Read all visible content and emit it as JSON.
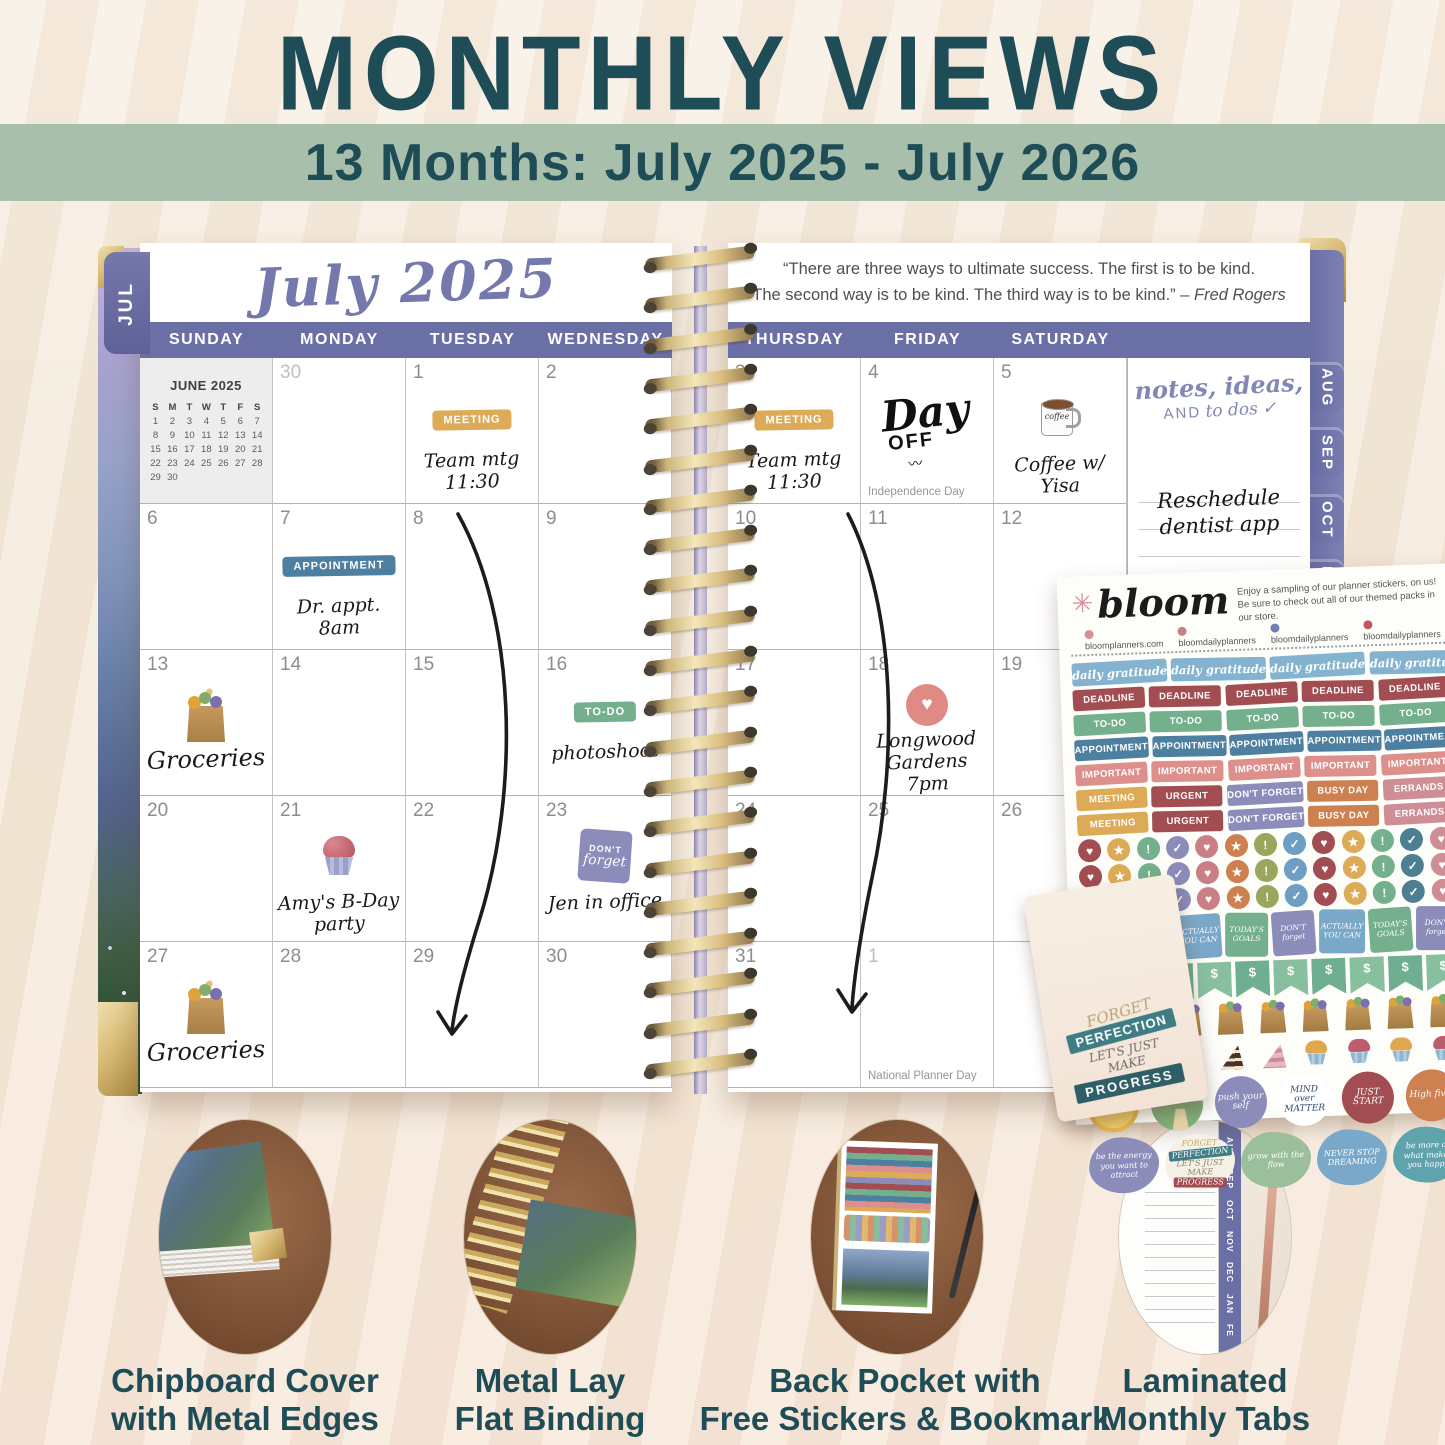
{
  "header": {
    "title": "MONTHLY VIEWS",
    "subtitle": "13 Months: July 2025 - July 2026"
  },
  "colors": {
    "accent_teal": "#1e4c57",
    "banner_green": "#a8bfac",
    "calendar_purple": "#6a6fa5",
    "script_purple": "#7478ad",
    "spiral_gold": "#d9bd7e"
  },
  "planner": {
    "left_tab": "JUL",
    "month_title": "July 2025",
    "days_left": [
      "SUNDAY",
      "MONDAY",
      "TUESDAY",
      "WEDNESDAY"
    ],
    "days_right": [
      "THURSDAY",
      "FRIDAY",
      "SATURDAY"
    ],
    "quote_line1": "“There are three ways to ultimate success. The first is to be kind.",
    "quote_line2": "The second way is to be kind. The third way is to be kind.” –",
    "quote_attr": "Fred Rogers",
    "mini_calendar": {
      "title": "JUNE 2025",
      "dow": [
        "S",
        "M",
        "T",
        "W",
        "T",
        "F",
        "S"
      ],
      "weeks": [
        [
          "1",
          "2",
          "3",
          "4",
          "5",
          "6",
          "7"
        ],
        [
          "8",
          "9",
          "10",
          "11",
          "12",
          "13",
          "14"
        ],
        [
          "15",
          "16",
          "17",
          "18",
          "19",
          "20",
          "21"
        ],
        [
          "22",
          "23",
          "24",
          "25",
          "26",
          "27",
          "28"
        ],
        [
          "29",
          "30",
          "",
          "",
          "",
          "",
          ""
        ]
      ]
    },
    "left_cells": [
      {
        "mini": true
      },
      {
        "num": "30",
        "dim": true
      },
      {
        "num": "1",
        "sticker": {
          "label": "MEETING",
          "color": "#ddab57"
        },
        "notes": [
          "Team mtg",
          "11:30"
        ]
      },
      {
        "num": "2"
      },
      {
        "num": "6"
      },
      {
        "num": "7",
        "sticker": {
          "label": "APPOINTMENT",
          "color": "#4d7fa0"
        },
        "notes": [
          "Dr. appt.",
          "8am"
        ]
      },
      {
        "num": "8"
      },
      {
        "num": "9"
      },
      {
        "num": "13",
        "icon": "grocery-bag",
        "notes": [
          "Groceries"
        ],
        "big": true
      },
      {
        "num": "14"
      },
      {
        "num": "15"
      },
      {
        "num": "16",
        "sticker": {
          "label": "TO-DO",
          "color": "#74b08d"
        },
        "notes": [
          "photoshoot"
        ]
      },
      {
        "num": "20"
      },
      {
        "num": "21",
        "icon": "cupcake",
        "notes": [
          "Amy's B-Day",
          "party"
        ]
      },
      {
        "num": "22"
      },
      {
        "num": "23",
        "icon": "dont-forget",
        "notes": [
          "Jen in office"
        ]
      },
      {
        "num": "27",
        "icon": "grocery-bag",
        "notes": [
          "Groceries"
        ],
        "big": true
      },
      {
        "num": "28"
      },
      {
        "num": "29"
      },
      {
        "num": "30"
      }
    ],
    "right_cells": [
      {
        "num": "3",
        "sticker": {
          "label": "MEETING",
          "color": "#ddab57"
        },
        "notes": [
          "Team mtg",
          "11:30"
        ]
      },
      {
        "num": "4",
        "dayoff": true,
        "foot": "Independence Day"
      },
      {
        "num": "5",
        "icon": "coffee-mug",
        "notes": [
          "Coffee w/",
          "Yisa"
        ]
      },
      {
        "num": "10"
      },
      {
        "num": "11"
      },
      {
        "num": "12"
      },
      {
        "num": "17"
      },
      {
        "num": "18",
        "icon": "heart",
        "notes": [
          "Longwood",
          "Gardens",
          "7pm"
        ]
      },
      {
        "num": "19"
      },
      {
        "num": "24"
      },
      {
        "num": "25"
      },
      {
        "num": "26"
      },
      {
        "num": "31"
      },
      {
        "num": "1",
        "dim": true,
        "foot": "National Planner Day"
      },
      {
        "aug": true
      }
    ],
    "day_off_line1": "Day",
    "day_off_line2": "OFF",
    "day_off_underline": "〰",
    "mug_text": "coffee",
    "dont_forget_sticker": {
      "line1": "DON'T",
      "line2": "forget"
    },
    "heart_glyph": "♥",
    "aug_mini": {
      "head": "A",
      "dow": "S",
      "col": [
        "3",
        "10",
        "17",
        "24",
        "31"
      ]
    },
    "notes_panel": {
      "title_line1": "notes, ideas,",
      "title_and": "AND",
      "title_line2": "to dos",
      "title_check": "✓",
      "entry": [
        "Reschedule",
        "dentist app"
      ]
    },
    "tabs_right": [
      "AUG",
      "SEP",
      "OCT",
      "NOV"
    ]
  },
  "sticker_sheet": {
    "brand": "bloom",
    "flower_glyph": "✳",
    "tagline1": "Enjoy a sampling of our planner stickers, on us!",
    "tagline2": "Be sure to check out all of our themed packs in our store.",
    "social": [
      {
        "icon": "flower-icon",
        "color": "#d98f97",
        "text": "bloomplanners.com"
      },
      {
        "icon": "instagram-icon",
        "color": "#c97f85",
        "text": "bloomdailyplanners"
      },
      {
        "icon": "facebook-icon",
        "color": "#6f7fb0",
        "text": "bloomdailyplanners"
      },
      {
        "icon": "pinterest-icon",
        "color": "#c0565e",
        "text": "bloomdailyplanners"
      }
    ],
    "script_row": {
      "label": "daily gratitude",
      "color": "#84b3d0",
      "count": 4
    },
    "label_rows": [
      {
        "labels": [
          "DEADLINE",
          "DEADLINE",
          "DEADLINE",
          "DEADLINE",
          "DEADLINE"
        ],
        "colors": [
          "#a14d52",
          "#a14d52",
          "#a14d52",
          "#a14d52",
          "#a14d52"
        ]
      },
      {
        "labels": [
          "TO-DO",
          "TO-DO",
          "TO-DO",
          "TO-DO",
          "TO-DO"
        ],
        "colors": [
          "#74b08d",
          "#74b08d",
          "#74b08d",
          "#74b08d",
          "#74b08d"
        ]
      },
      {
        "labels": [
          "APPOINTMENT",
          "APPOINTMENT",
          "APPOINTMENT",
          "APPOINTMENT",
          "APPOINTMENT"
        ],
        "colors": [
          "#4d7fa0",
          "#4d7fa0",
          "#4d7fa0",
          "#4d7fa0",
          "#4d7fa0"
        ]
      },
      {
        "labels": [
          "IMPORTANT",
          "IMPORTANT",
          "IMPORTANT",
          "IMPORTANT",
          "IMPORTANT"
        ],
        "colors": [
          "#dd8f8c",
          "#dd8f8c",
          "#dd8f8c",
          "#dd8f8c",
          "#dd8f8c"
        ]
      },
      {
        "labels": [
          "MEETING",
          "URGENT",
          "DON'T FORGET",
          "BUSY DAY",
          "ERRANDS"
        ],
        "colors": [
          "#ddab57",
          "#a14d52",
          "#8b8cba",
          "#cd8050",
          "#cf8d96"
        ]
      },
      {
        "labels": [
          "MEETING",
          "URGENT",
          "DON'T FORGET",
          "BUSY DAY",
          "ERRANDS"
        ],
        "colors": [
          "#ddab57",
          "#a14d52",
          "#8b8cba",
          "#cd8050",
          "#cf8d96"
        ]
      }
    ],
    "dot_rows": 3,
    "dot_icons": [
      "♥",
      "★",
      "!",
      "✓"
    ],
    "dot_colors": [
      "#a14d52",
      "#ddab57",
      "#74b08d",
      "#8b8cba",
      "#c97f85",
      "#cd8050",
      "#9aa65c",
      "#6f9ec4",
      "#a14d52",
      "#ddab57",
      "#74b08d",
      "#4d7f93",
      "#cf8d96"
    ],
    "square_stickers": [
      {
        "text": "TODAY'S GOALS",
        "color": "#74b08d"
      },
      {
        "text": "DON'T forget",
        "color": "#8b8cba"
      },
      {
        "text": "ACTUALLY YOU CAN",
        "color": "#7aa8c9"
      },
      {
        "text": "TODAY'S GOALS",
        "color": "#74b08d"
      },
      {
        "text": "DON'T forget",
        "color": "#8b8cba"
      },
      {
        "text": "ACTUALLY YOU CAN",
        "color": "#7aa8c9"
      },
      {
        "text": "TODAY'S GOALS",
        "color": "#74b08d"
      },
      {
        "text": "DON'T forget",
        "color": "#8b8cba"
      }
    ],
    "flag_label": "$",
    "flag_count": 10,
    "flag_colors": [
      "#6fae8f",
      "#87bf9f"
    ],
    "bag_count": 9,
    "cake_items": [
      "slice-pink",
      "slice-choc",
      "slice-pink",
      "slice-choc",
      "slice-pink",
      "cupcake-gold",
      "cupcake-berry",
      "cupcake-gold",
      "cupcake-berry"
    ],
    "motivation_circles": [
      {
        "type": "sun",
        "text": "☀"
      },
      {
        "type": "path",
        "text": ""
      },
      {
        "type": "text",
        "text": "push your self",
        "color": "#8b8cba",
        "text_color": "#ffffff"
      },
      {
        "type": "text",
        "text": "MIND over MATTER",
        "color": "#ffffff",
        "text_color": "#2f4a6e"
      },
      {
        "type": "text",
        "text": "JUST START",
        "color": "#a14d52",
        "text_color": "#ffffff"
      },
      {
        "type": "text",
        "text": "High five!",
        "color": "#cd8050",
        "text_color": "#ffffff"
      }
    ],
    "quote_stickers": [
      {
        "style": "plain",
        "text": "be the energy you want to attract",
        "color": "#8b8cba"
      },
      {
        "style": "multi",
        "parts": [
          "FORGET",
          "PERFECTION",
          "LET'S JUST MAKE",
          "PROGRESS"
        ]
      },
      {
        "style": "plain",
        "text": "grow with the flow",
        "color": "#9bbf9a"
      },
      {
        "style": "plain",
        "text": "NEVER STOP DREAMING",
        "color": "#7aa8c9"
      },
      {
        "style": "plain",
        "text": "be more of what makes you happy",
        "color": "#5fa3ad"
      }
    ]
  },
  "bookmark": {
    "lines": [
      "FORGET",
      "PERFECTION",
      "LET'S JUST",
      "MAKE",
      "PROGRESS"
    ]
  },
  "features": [
    {
      "caption": [
        "Chipboard Cover",
        "with Metal Edges"
      ]
    },
    {
      "caption": [
        "Metal Lay",
        "Flat Binding"
      ]
    },
    {
      "caption": [
        "Back Pocket with",
        "Free Stickers & Bookmark"
      ]
    },
    {
      "caption": [
        "Laminated",
        "Monthly Tabs"
      ],
      "tab_months": [
        "AUG",
        "SEP",
        "OCT",
        "NOV",
        "DEC",
        "JAN",
        "FE"
      ]
    }
  ]
}
